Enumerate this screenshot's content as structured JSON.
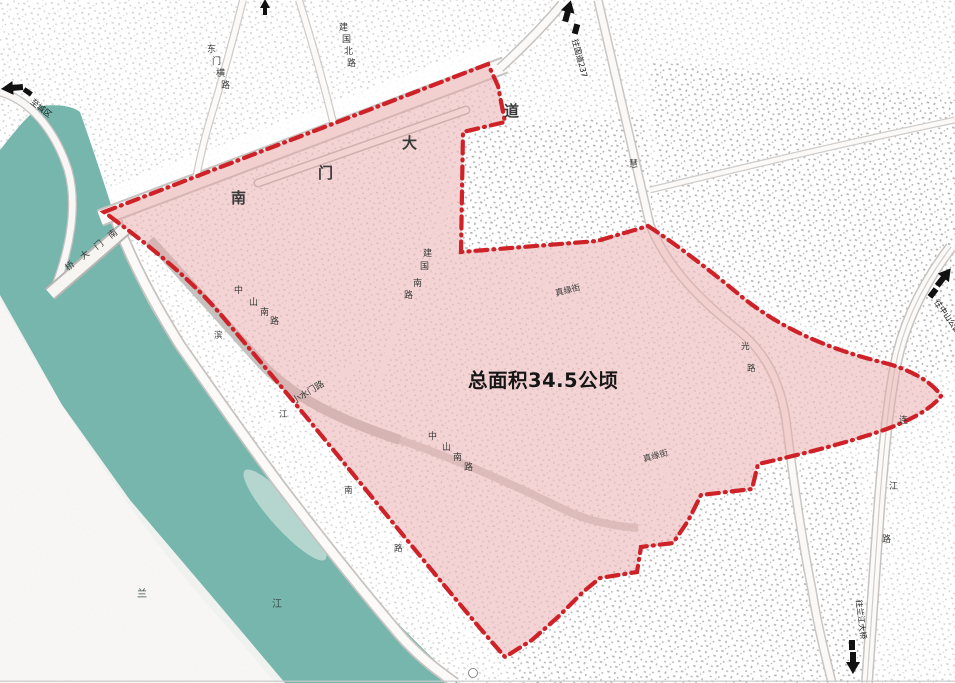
{
  "map": {
    "area_label": "总面积34.5公顷",
    "colors": {
      "boundary": "#cf2128",
      "highlight": "#e8a7a7",
      "river": "#77b6ac",
      "road_casing": "#c6c3c0"
    },
    "roads": {
      "nanmen_dadao": [
        "南",
        "门",
        "大",
        "道"
      ],
      "nanmen_bridge": [
        "桥",
        "大",
        "门",
        "南"
      ],
      "zhongshan_south_a": [
        "中",
        "山",
        "南",
        "路"
      ],
      "zhongshan_south_b": [
        "中",
        "山",
        "南",
        "路"
      ],
      "jianguo_south": [
        "建",
        "国",
        "南",
        "路"
      ],
      "jianguo_north": [
        "建",
        "国",
        "北",
        "路"
      ],
      "dongmen_heng": [
        "东",
        "门",
        "横",
        "路"
      ],
      "binjiang_south": [
        "滨",
        "江",
        "南",
        "路"
      ],
      "lianjiang": [
        "连",
        "江",
        "路"
      ],
      "xiaoshuimen": "小水门路",
      "zhenyuan_street_a": "真缘街",
      "zhenyuan_street_b": "真缘街",
      "hui_road": "慧",
      "guang_char": "光",
      "lu_char": "路"
    },
    "river_name": [
      "兰",
      "江"
    ],
    "arrows": {
      "top": "往国道237",
      "left": "至城区",
      "right": "往中山公园",
      "bottom_right": "往兰江大桥"
    }
  }
}
